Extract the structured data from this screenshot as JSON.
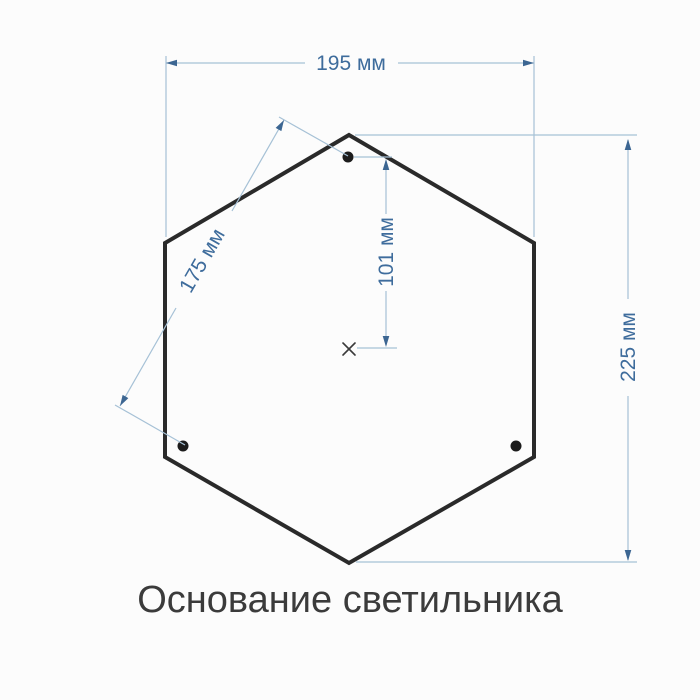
{
  "diagram": {
    "title": "Основание светильника",
    "shape": "hexagon",
    "unit": "мм",
    "holes_count": 3,
    "dimensions": {
      "width": {
        "value": 195,
        "label": "195 мм"
      },
      "height": {
        "value": 225,
        "label": "225 мм"
      },
      "hole_spacing": {
        "value": 175,
        "label": "175 мм"
      },
      "center_to_hole": {
        "value": 101,
        "label": "101 мм"
      }
    },
    "colors": {
      "outline": "#2a2a2a",
      "hole": "#1c1c1c",
      "dimension_line": "#a6c1d6",
      "dimension_arrow": "#3c6692",
      "dimension_text": "#3e6c9c",
      "title_text": "#3b3b3b",
      "background": "#fcfcfc"
    }
  }
}
